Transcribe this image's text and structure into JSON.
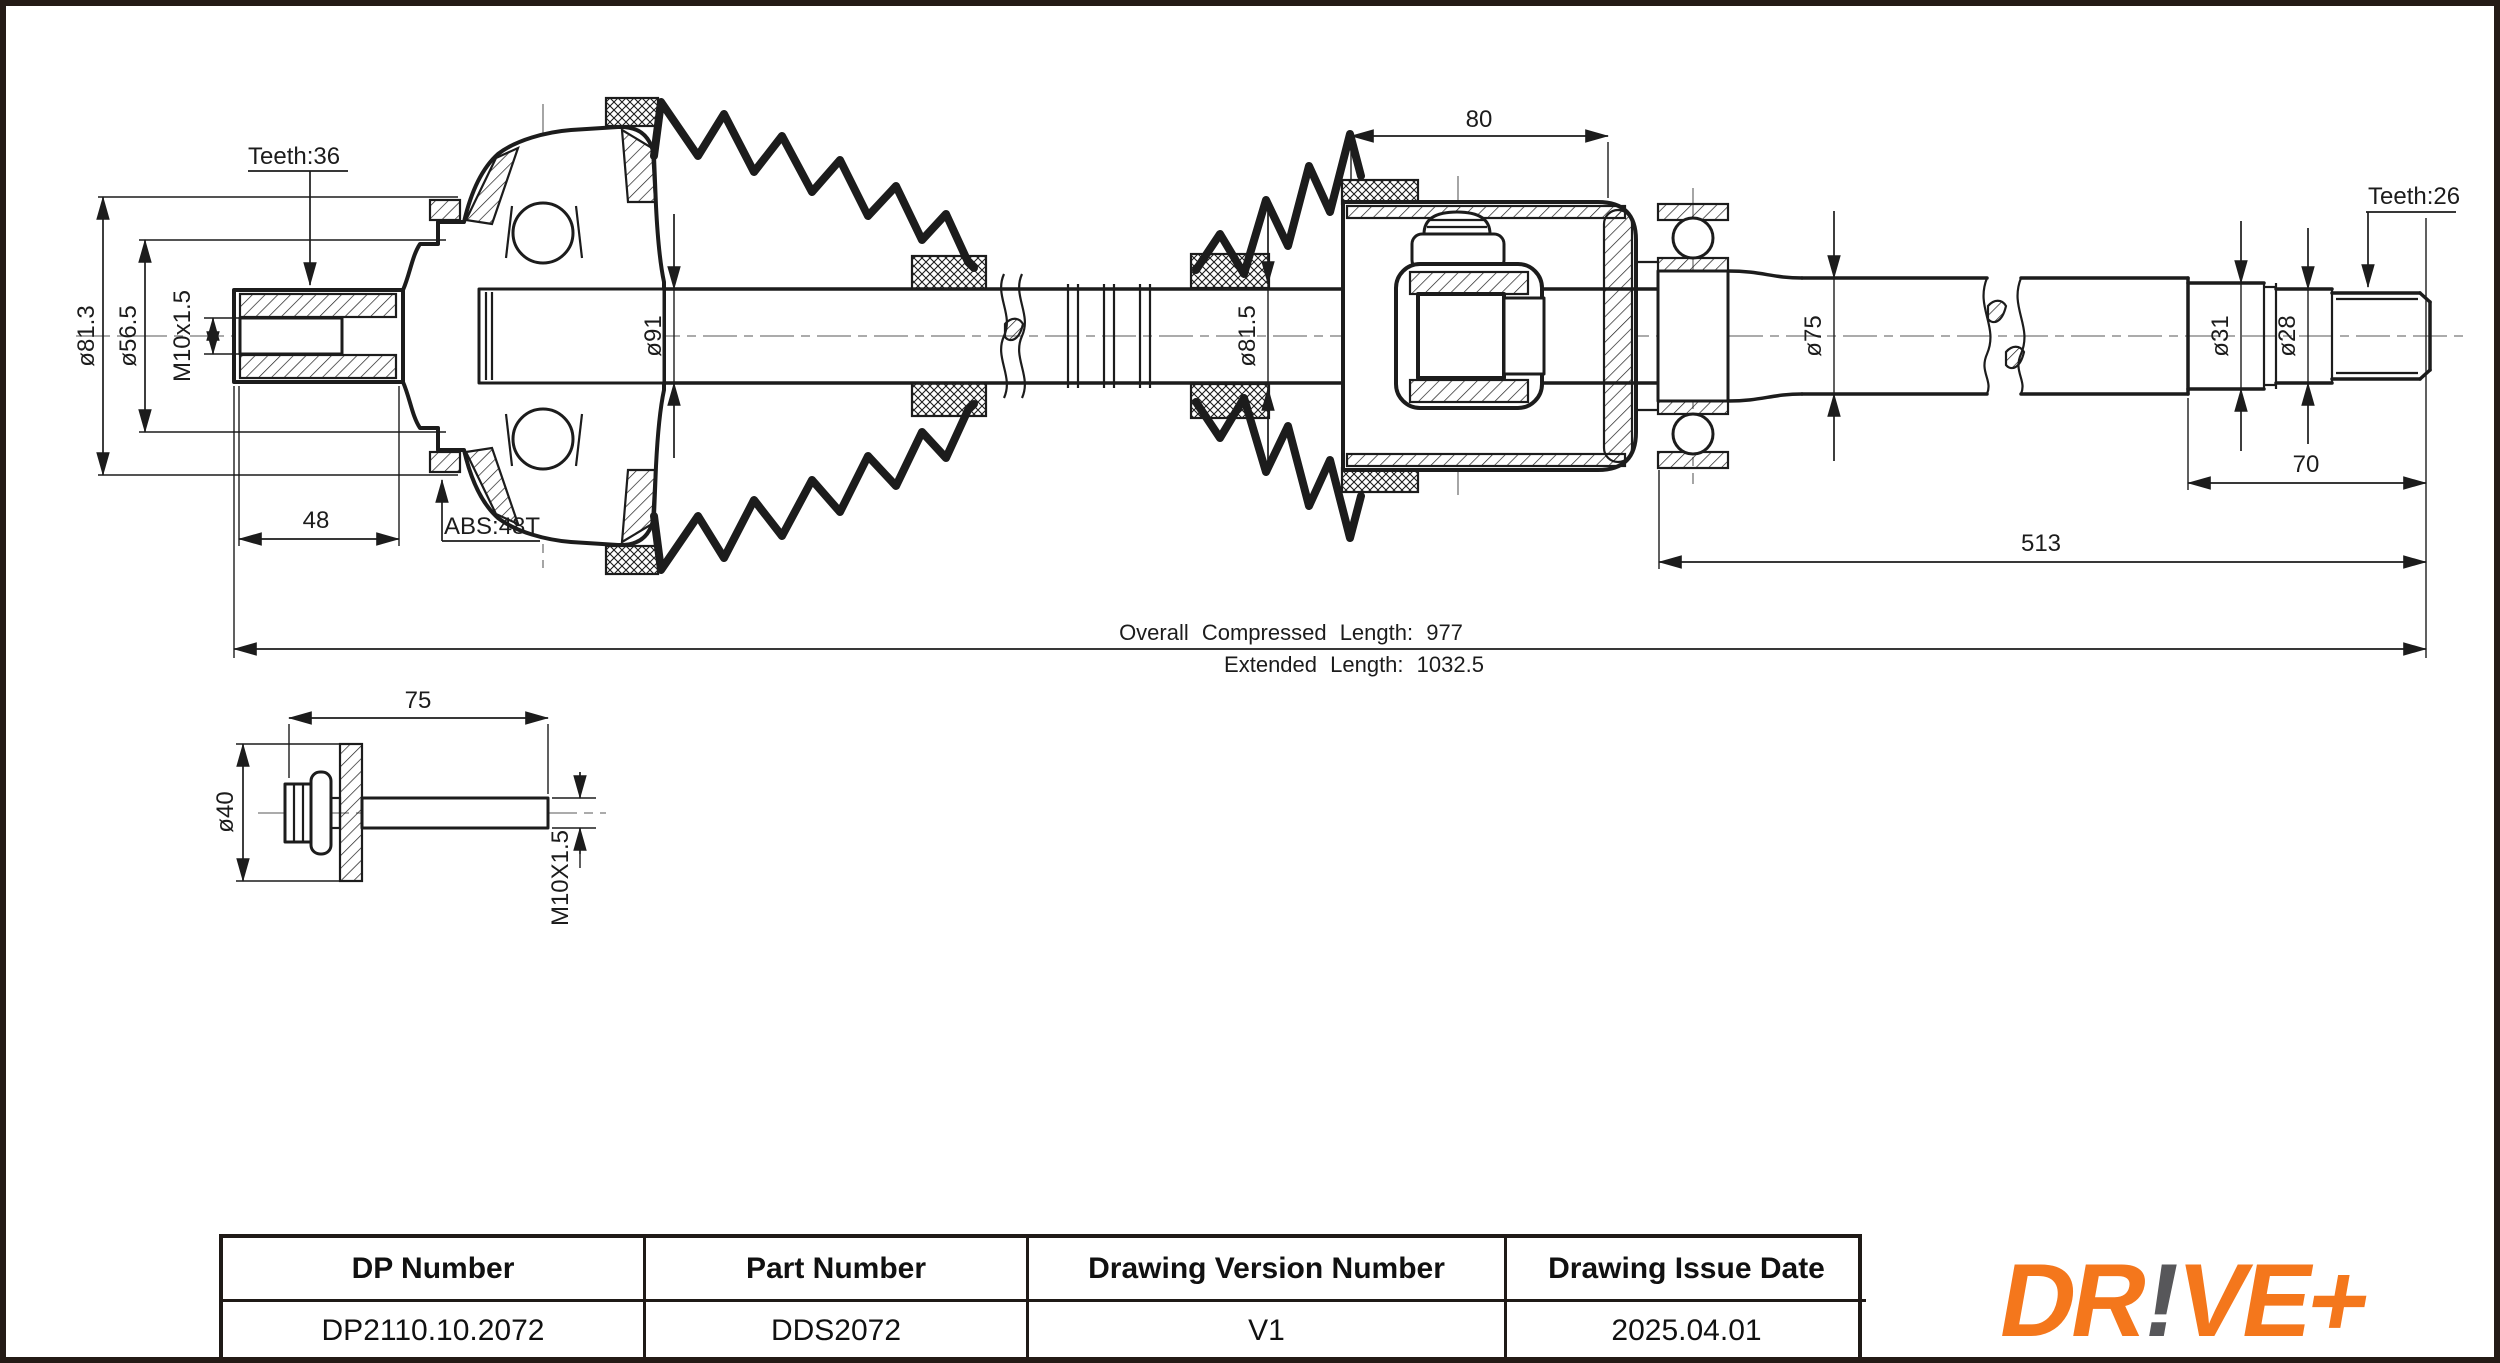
{
  "colors": {
    "ink": "#1c1c1c",
    "page_border": "#241b16",
    "logo_orange": "#f4771c",
    "logo_gray": "#57575a"
  },
  "drawing": {
    "labels": {
      "teeth_left": "Teeth:36",
      "dia_outer_left": "ø81.3",
      "dia_inner_left": "ø56.5",
      "thread_left": "M10x1.5",
      "stub_length": "48",
      "abs_ring": "ABS:48T",
      "dia_shaft_boot": "ø91",
      "housing_width": "80",
      "dia_boot_right": "ø81.5",
      "dia_bearing_shaft": "ø75",
      "dia_step1": "ø31",
      "dia_step2": "ø28",
      "teeth_right": "Teeth:26",
      "spline_length": "70",
      "shaft_length": "513",
      "overall_compressed": "Overall Compressed Length: 977",
      "extended": "Extended Length: 1032.5"
    },
    "bolt": {
      "length": "75",
      "dia_washer": "ø40",
      "thread": "M10X1.5"
    }
  },
  "title_block": {
    "columns": [
      {
        "header": "DP Number",
        "value": "DP2110.10.2072"
      },
      {
        "header": "Part Number",
        "value": "DDS2072"
      },
      {
        "header": "Drawing Version Number",
        "value": "V1"
      },
      {
        "header": "Drawing Issue Date",
        "value": "2025.04.01"
      }
    ]
  },
  "logo": {
    "part1": "DR",
    "bang": "!",
    "part2": "VE+"
  }
}
